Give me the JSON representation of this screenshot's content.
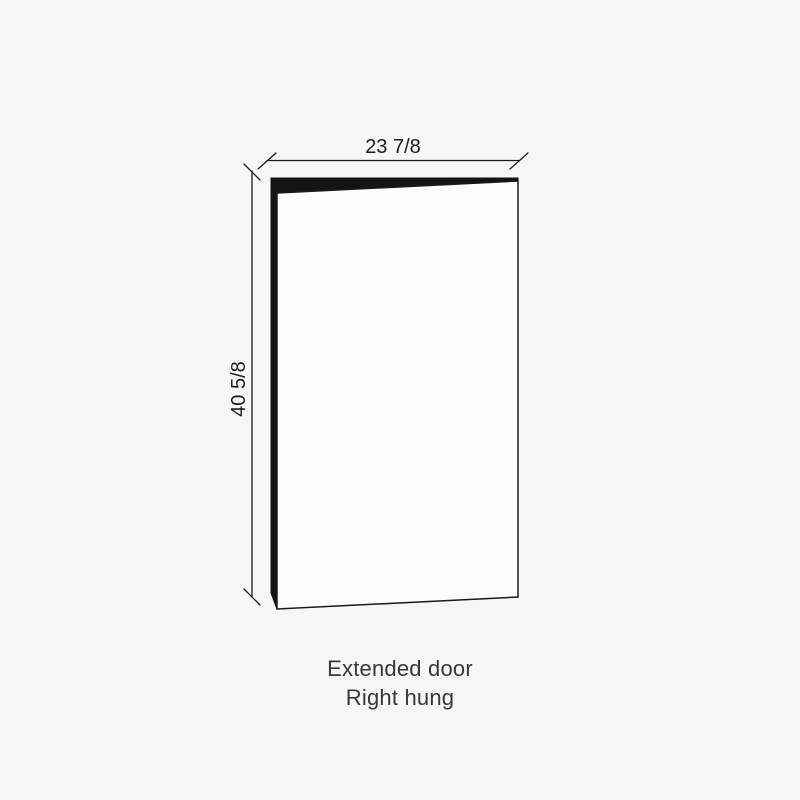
{
  "diagram": {
    "dimensions": {
      "width_label": "23 7/8",
      "height_label": "40 5/8"
    },
    "caption": {
      "line1": "Extended door",
      "line2": "Right hung"
    },
    "colors": {
      "background": "#f6f6f6",
      "door-face": "#fcfcfc",
      "edge-fill": "#141414",
      "line": "#1a1a1a",
      "dim-text": "#1c1c1c",
      "caption-text": "#383838"
    }
  }
}
